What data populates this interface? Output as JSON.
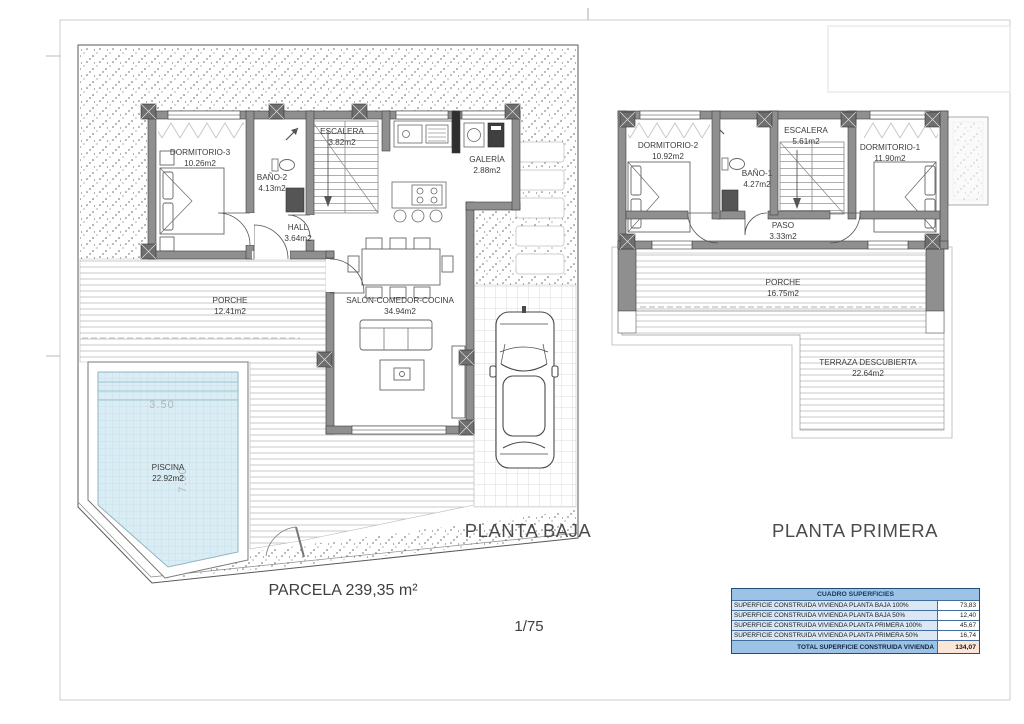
{
  "sheet": {
    "scale": "1/75",
    "parcel": "PARCELA 239,35 m²"
  },
  "ground_floor": {
    "title": "PLANTA BAJA",
    "rooms": [
      {
        "name": "DORMITORIO-3",
        "area": "10.26m2"
      },
      {
        "name": "BAÑO-2",
        "area": "4.13m2"
      },
      {
        "name": "ESCALERA",
        "area": "3.82m2"
      },
      {
        "name": "GALERÍA",
        "area": "2.88m2"
      },
      {
        "name": "HALL",
        "area": "3.64m2"
      },
      {
        "name": "SALÓN-COMEDOR-COCINA",
        "area": "34.94m2"
      },
      {
        "name": "PORCHE",
        "area": "12.41m2"
      },
      {
        "name": "PISCINA",
        "area": "22.92m2"
      }
    ],
    "pool": {
      "width": "3.50",
      "length": "7.00"
    }
  },
  "first_floor": {
    "title": "PLANTA PRIMERA",
    "rooms": [
      {
        "name": "DORMITORIO-2",
        "area": "10.92m2"
      },
      {
        "name": "BAÑO-1",
        "area": "4.27m2"
      },
      {
        "name": "ESCALERA",
        "area": "5.61m2"
      },
      {
        "name": "DORMITORIO-1",
        "area": "11.90m2"
      },
      {
        "name": "PASO",
        "area": "3.33m2"
      },
      {
        "name": "PORCHE",
        "area": "16.75m2"
      },
      {
        "name": "TERRAZA DESCUBIERTA",
        "area": "22.64m2"
      }
    ]
  },
  "areas_table": {
    "title": "CUADRO SUPERFICIES",
    "rows": [
      {
        "label": "SUPERFICIE CONSTRUIDA VIVIENDA PLANTA BAJA 100%",
        "value": "73,83"
      },
      {
        "label": "SUPERFICIE CONSTRUIDA VIVIENDA PLANTA BAJA 50%",
        "value": "12,40"
      },
      {
        "label": "SUPERFICIE CONSTRUIDA VIVIENDA PLANTA PRIMERA 100%",
        "value": "45,67"
      },
      {
        "label": "SUPERFICIE CONSTRUIDA VIVIENDA PLANTA PRIMERA 50%",
        "value": "16,74"
      }
    ],
    "total": {
      "label": "TOTAL SUPERFICIE CONSTRUIDA VIVIENDA",
      "value": "134,07"
    },
    "colors": {
      "header_bg": "#9cc2e5",
      "row_bg": "#dbe7f4",
      "total_value_bg": "#fbe5d6",
      "wall": "#8f8f8f",
      "pool_water": "#daedf4"
    }
  }
}
